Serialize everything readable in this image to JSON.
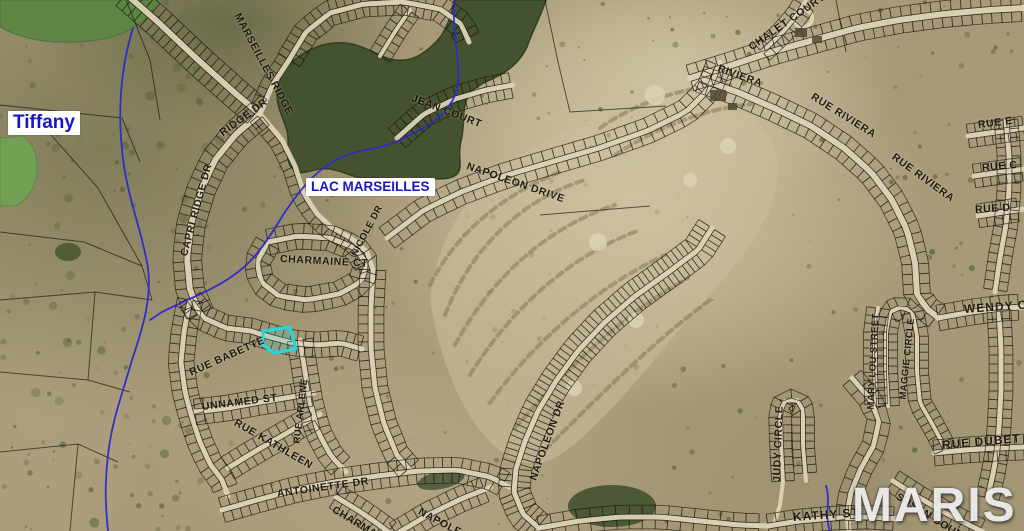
{
  "map": {
    "watermark": "MARIS",
    "colors": {
      "highlight": "#24d8de",
      "water_label": "#1717c4",
      "street_label": "#161208",
      "watermark_color": "#ececec",
      "water": "#45522f",
      "pond": "#72a055",
      "stream": "#2a2ace",
      "road": "#dcd2b6",
      "parcel_line": "#17130c"
    },
    "place_labels": {
      "tiffany": "Tiffany",
      "lac_marseilles": "LAC MARSEILLES"
    },
    "street_labels": {
      "marseilles_ridge": "MARSEILLES RIDGE",
      "capri_ridge_dr": "CAPRI RIDGE DR",
      "ridge_dr": "RIDGE DR",
      "jean_court": "JEAN COURT",
      "napoleon_drive": "NAPOLEON DRIVE",
      "nicole_dr": "NICOLE DR",
      "charmaine_ct": "CHARMAINE CT",
      "rue_babette": "RUE BABETTE",
      "rue_arlene": "RUE ARLENE",
      "unnamed_st": "UNNAMED ST",
      "rue_kathleen": "RUE KATHLEEN",
      "antoinette_dr": "ANTOINETTE DR",
      "charmaine": "CHARMAINE",
      "napoleon": "NAPOLEON",
      "napoleon_dr": "NAPOLEON DR",
      "chalet_court": "CHALET COURT",
      "riviera": "RIVIERA",
      "rue_riviera": "RUE RIVIERA",
      "rue_riviera_2": "RUE RIVIERA",
      "rue_e": "RUE E",
      "rue_c": "RUE C",
      "rue_d": "RUE D",
      "wendy_ct": "WENDY CT",
      "mary_lou_street": "MARY LOU STREET",
      "maggie_circle": "MAGGIE CIRCLE",
      "rue_dubet": "RUE DUBET",
      "judy_circle": "JUDY CIRCLE",
      "kathy_st": "KATHY ST",
      "susan_court": "SUSAN COURT"
    }
  }
}
